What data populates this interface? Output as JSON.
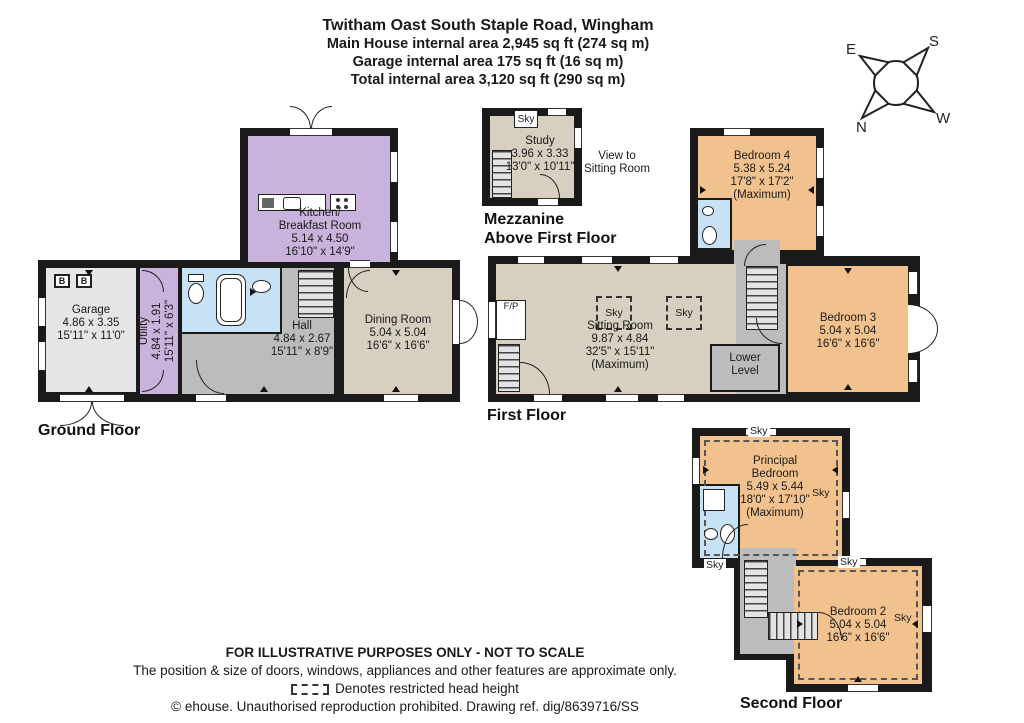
{
  "title": {
    "line1": "Twitham Oast South Staple Road, Wingham",
    "line2": "Main House internal area 2,945 sq ft (274 sq m)",
    "line3": "Garage internal area 175 sq ft (16 sq m)",
    "line4": "Total internal area 3,120 sq ft (290 sq m)"
  },
  "compass": {
    "n": "N",
    "s": "S",
    "e": "E",
    "w": "W"
  },
  "mezzanine": {
    "floor_label_line1": "Mezzanine",
    "floor_label_line2": "Above First Floor",
    "study": {
      "name": "Study",
      "metric": "3.96 x 3.33",
      "imperial": "13'0\" x 10'11\""
    },
    "note_line1": "View to",
    "note_line2": "Sitting Room",
    "sky": "Sky"
  },
  "ground_floor": {
    "floor_label": "Ground Floor",
    "boiler_label": "B",
    "rooms": {
      "kitchen": {
        "name_line1": "Kitchen/",
        "name_line2": "Breakfast Room",
        "metric": "5.14 x 4.50",
        "imperial": "16'10\" x 14'9\""
      },
      "garage": {
        "name": "Garage",
        "metric": "4.86 x 3.35",
        "imperial": "15'11\" x 11'0\""
      },
      "utility": {
        "name": "Utility",
        "metric": "4.84 x 1.91",
        "imperial": "15'11\" x 6'3\""
      },
      "hall": {
        "name": "Hall",
        "metric": "4.84 x 2.67",
        "imperial": "15'11\" x 8'9\""
      },
      "dining": {
        "name": "Dining Room",
        "metric": "5.04 x 5.04",
        "imperial": "16'6\" x 16'6\""
      }
    }
  },
  "first_floor": {
    "floor_label": "First Floor",
    "fireplace_label": "F/P",
    "sky": "Sky",
    "rooms": {
      "sitting": {
        "name": "Sitting Room",
        "metric": "9.87 x 4.84",
        "imperial": "32'5\" x 15'11\"",
        "qualifier": "(Maximum)"
      },
      "bedroom4": {
        "name": "Bedroom 4",
        "metric": "5.38 x 5.24",
        "imperial": "17'8\" x 17'2\"",
        "qualifier": "(Maximum)"
      },
      "bedroom3": {
        "name": "Bedroom 3",
        "metric": "5.04 x 5.04",
        "imperial": "16'6\" x 16'6\""
      },
      "lower_level": {
        "name_line1": "Lower",
        "name_line2": "Level"
      }
    }
  },
  "second_floor": {
    "floor_label": "Second Floor",
    "sky": "Sky",
    "rooms": {
      "principal": {
        "name_line1": "Principal",
        "name_line2": "Bedroom",
        "metric": "5.49 x 5.44",
        "imperial": "18'0\" x 17'10\"",
        "qualifier": "(Maximum)"
      },
      "bedroom2": {
        "name": "Bedroom 2",
        "metric": "5.04 x 5.04",
        "imperial": "16'6\" x 16'6\""
      }
    }
  },
  "footer": {
    "line1": "FOR ILLUSTRATIVE PURPOSES ONLY - NOT TO SCALE",
    "line2": "The position & size of doors, windows, appliances and other features are approximate only.",
    "line3": "Denotes restricted head height",
    "line4": "© ehouse. Unauthorised reproduction prohibited. Drawing ref. dig/8639716/SS"
  },
  "colors": {
    "wall": "#1a1a1a",
    "kitchen_utility_purple": "#c9b2dc",
    "living_beige": "#d7cfbf",
    "bedroom_orange": "#f2c28e",
    "hall_gray": "#bcbcbc",
    "garage_gray": "#e6e6e6",
    "bathroom_blue": "#c7e1f5"
  }
}
